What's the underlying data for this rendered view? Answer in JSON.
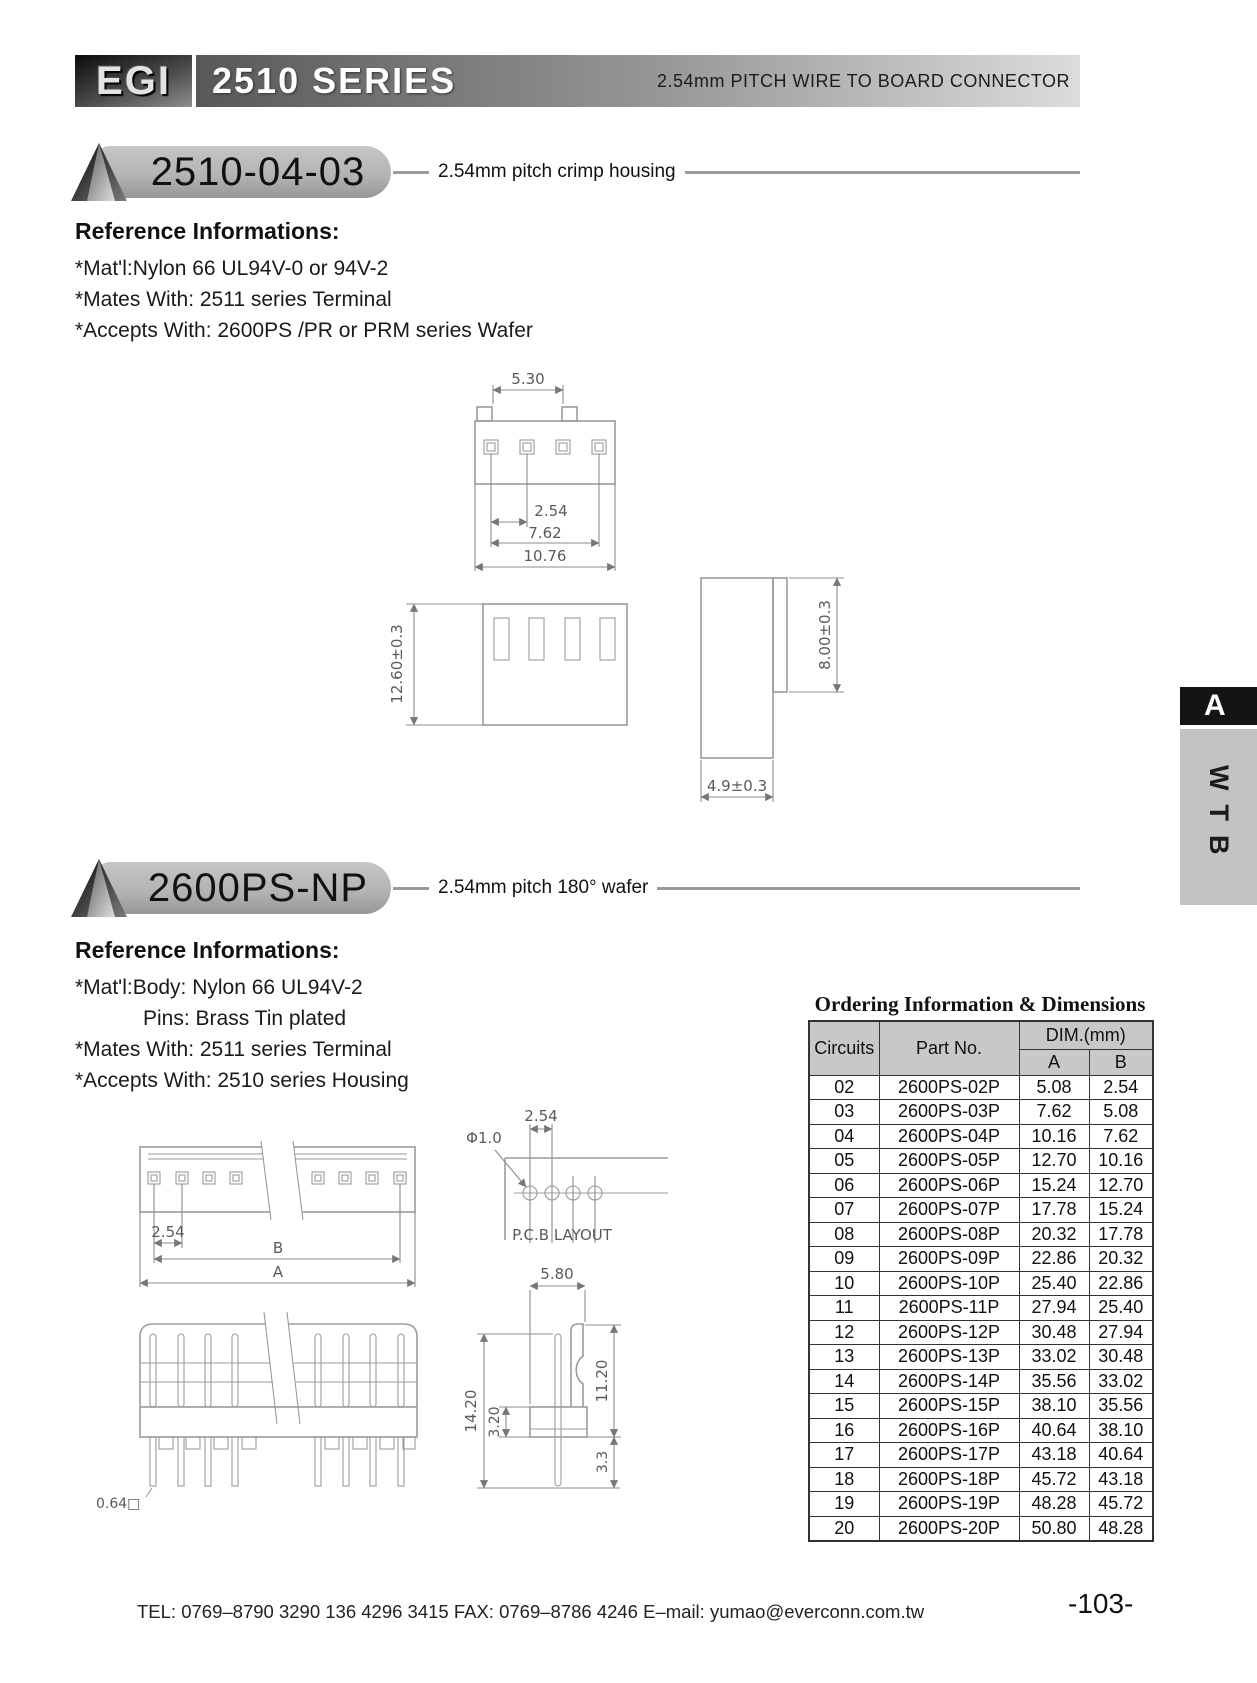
{
  "header": {
    "logo": "EGI",
    "title": "2510 SERIES",
    "subtitle": "2.54mm PITCH WIRE TO BOARD CONNECTOR"
  },
  "sidebar": {
    "tab": "A",
    "vertical_label": "WTB"
  },
  "section1": {
    "badge": "2510-04-03",
    "tagline": "2.54mm pitch crimp housing",
    "ref_heading": "Reference Informations:",
    "ref_line1": "*Mat'l:Nylon 66 UL94V-0 or 94V-2",
    "ref_line2": "*Mates With: 2511 series Terminal",
    "ref_line3": "*Accepts With: 2600PS /PR or PRM series Wafer",
    "dims": {
      "top_width": "5.30",
      "pitch": "2.54",
      "row_span": "7.62",
      "overall_width": "10.76",
      "height": "12.60±0.3",
      "side_height": "8.00±0.3",
      "depth": "4.9±0.3"
    }
  },
  "section2": {
    "badge": "2600PS-NP",
    "tagline": "2.54mm pitch 180° wafer",
    "ref_heading": "Reference Informations:",
    "ref_line1": "*Mat'l:Body:  Nylon 66 UL94V-2",
    "ref_line2": "Pins: Brass Tin plated",
    "ref_line3": "*Mates With: 2511 series Terminal",
    "ref_line4": "*Accepts With: 2510 series Housing",
    "dims": {
      "pitch": "2.54",
      "dim_b": "B",
      "dim_a": "A",
      "hole_dia": "Φ1.0",
      "pcb_pitch": "2.54",
      "pcb_label": "P.C.B LAYOUT",
      "side_width": "5.80",
      "total_height": "14.20",
      "body_height": "3.20",
      "wall_height": "11.20",
      "pin_below": "3.3",
      "pin_square": "0.64□"
    }
  },
  "table": {
    "title": "Ordering Information & Dimensions",
    "headers": {
      "circuits": "Circuits",
      "part": "Part No.",
      "dim": "DIM.(mm)",
      "a": "A",
      "b": "B"
    },
    "rows": [
      {
        "circuits": "02",
        "part": "2600PS-02P",
        "a": "5.08",
        "b": "2.54"
      },
      {
        "circuits": "03",
        "part": "2600PS-03P",
        "a": "7.62",
        "b": "5.08"
      },
      {
        "circuits": "04",
        "part": "2600PS-04P",
        "a": "10.16",
        "b": "7.62"
      },
      {
        "circuits": "05",
        "part": "2600PS-05P",
        "a": "12.70",
        "b": "10.16"
      },
      {
        "circuits": "06",
        "part": "2600PS-06P",
        "a": "15.24",
        "b": "12.70"
      },
      {
        "circuits": "07",
        "part": "2600PS-07P",
        "a": "17.78",
        "b": "15.24"
      },
      {
        "circuits": "08",
        "part": "2600PS-08P",
        "a": "20.32",
        "b": "17.78"
      },
      {
        "circuits": "09",
        "part": "2600PS-09P",
        "a": "22.86",
        "b": "20.32"
      },
      {
        "circuits": "10",
        "part": "2600PS-10P",
        "a": "25.40",
        "b": "22.86"
      },
      {
        "circuits": "11",
        "part": "2600PS-11P",
        "a": "27.94",
        "b": "25.40"
      },
      {
        "circuits": "12",
        "part": "2600PS-12P",
        "a": "30.48",
        "b": "27.94"
      },
      {
        "circuits": "13",
        "part": "2600PS-13P",
        "a": "33.02",
        "b": "30.48"
      },
      {
        "circuits": "14",
        "part": "2600PS-14P",
        "a": "35.56",
        "b": "33.02"
      },
      {
        "circuits": "15",
        "part": "2600PS-15P",
        "a": "38.10",
        "b": "35.56"
      },
      {
        "circuits": "16",
        "part": "2600PS-16P",
        "a": "40.64",
        "b": "38.10"
      },
      {
        "circuits": "17",
        "part": "2600PS-17P",
        "a": "43.18",
        "b": "40.64"
      },
      {
        "circuits": "18",
        "part": "2600PS-18P",
        "a": "45.72",
        "b": "43.18"
      },
      {
        "circuits": "19",
        "part": "2600PS-19P",
        "a": "48.28",
        "b": "45.72"
      },
      {
        "circuits": "20",
        "part": "2600PS-20P",
        "a": "50.80",
        "b": "48.28"
      }
    ]
  },
  "footer": {
    "contact": "TEL: 0769–8790 3290  136 4296 3415  FAX: 0769–8786 4246  E–mail: yumao@everconn.com.tw",
    "page": "-103-"
  }
}
